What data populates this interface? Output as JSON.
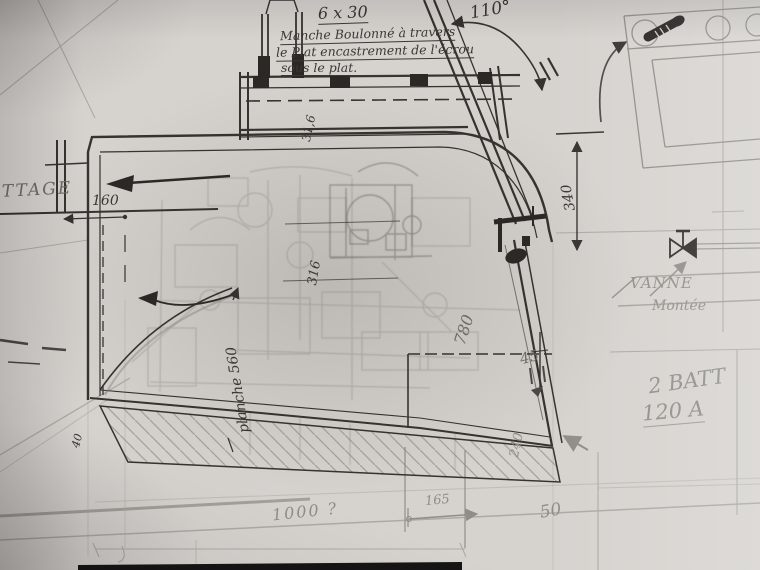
{
  "notes": {
    "bolt_spec": "6 x 30",
    "bolt_note_line1": "Manche Boulonné à travers",
    "bolt_note_line2": "le Plat encastrement de l'écrou",
    "bolt_note_line3": "sous le plat."
  },
  "labels": {
    "angle": "110°",
    "ttage": "TTAGE",
    "vanne": "VANNE",
    "montee": "Montée",
    "planche": "planche 560",
    "batteries_line1": "2 BATT",
    "batteries_line2": "120 A"
  },
  "dimensions": {
    "d160": "160",
    "d340": "340",
    "d316_top": "31,6",
    "d316_mid": "316",
    "d780": "780",
    "d45": "45",
    "d40": "40",
    "d240": "240",
    "d165": "165",
    "d50": "50",
    "d1000": "1000 ?"
  },
  "icons": {
    "valve": "valve-icon",
    "bolt": "bolt-icon"
  },
  "colors": {
    "ink": "#35332f",
    "pencil": "#8f8d87",
    "pencil_light": "#a5a39e",
    "paper": "#d6d3cf",
    "photo_edge": "#151515"
  }
}
